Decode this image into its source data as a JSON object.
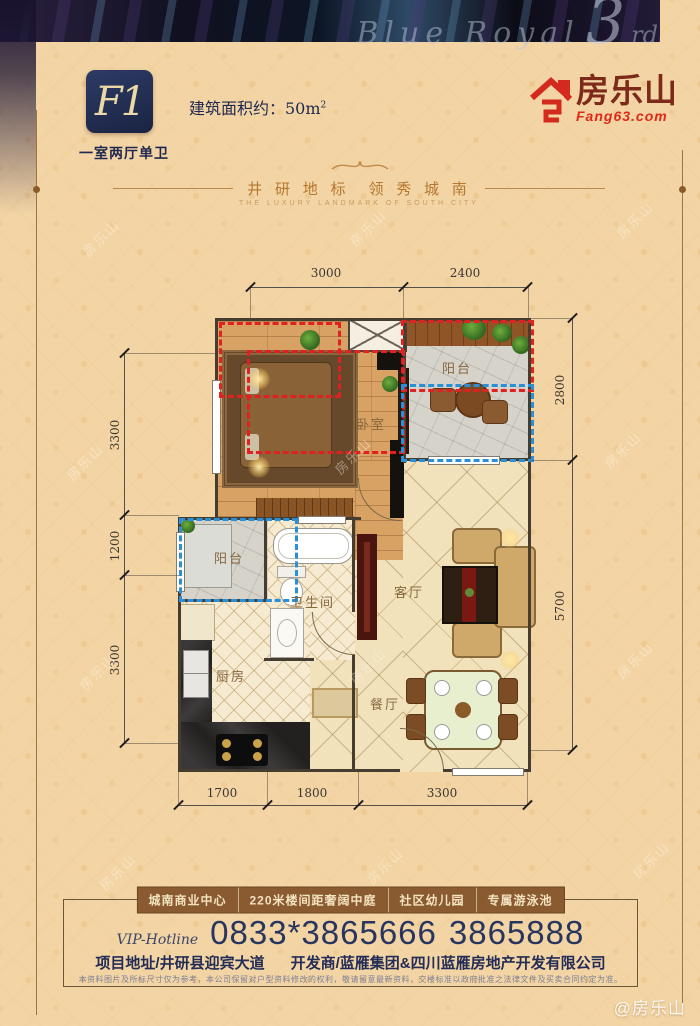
{
  "colors": {
    "beige": "#f3d5a5",
    "navy": "#232c56",
    "brand_red": "#e02818",
    "brand_maroon": "#7d2a1a",
    "banner_brown": "#8a5a30",
    "red_dash": "#e02121",
    "blue_dash": "#2b8fd8"
  },
  "header": {
    "unit_code": "F1",
    "unit_type": "一室两厅单卫",
    "area_label": "建筑面积约：50m",
    "area_sup": "2",
    "script": {
      "pre": "Blue Royal",
      "num": "3",
      "suf": "rd"
    },
    "logo": {
      "name": "房乐山",
      "site": "Fang63.com"
    }
  },
  "divider": {
    "cn": "井 研 地 标　领 秀 城 南",
    "en": "THE LUXURY LANDMARK OF SOUTH CITY"
  },
  "plan": {
    "rooms": {
      "bedroom": "卧室",
      "balcony_top": "阳台",
      "balcony_left": "阳台",
      "bathroom": "卫生间",
      "kitchen": "厨房",
      "living": "客厅",
      "dining": "餐厅"
    },
    "dims": {
      "top": [
        "3000",
        "2400"
      ],
      "left": [
        "3300",
        "1200",
        "3300"
      ],
      "right": [
        "2800",
        "5700"
      ],
      "bottom": [
        "1700",
        "1800",
        "3300"
      ]
    }
  },
  "footer": {
    "features": [
      "城南商业中心",
      "220米楼间距奢阔中庭",
      "社区幼儿园",
      "专属游泳池"
    ],
    "hotline_label": "VIP-Hotline",
    "phone1": "0833*3865666",
    "phone2": "3865888",
    "address": "项目地址/井研县迎宾大道",
    "developer": "开发商/蓝雁集团&四川蓝雁房地产开发有限公司",
    "disclaimer": "本资料图片及所标尺寸仅为参考，本公司保留对户型资料修改的权利，敬请留意最新资料，交楼标准以政府批准之法律文件及买卖合同约定为准。",
    "site_mark": "@房乐山"
  },
  "watermark": {
    "text": "房乐山"
  }
}
